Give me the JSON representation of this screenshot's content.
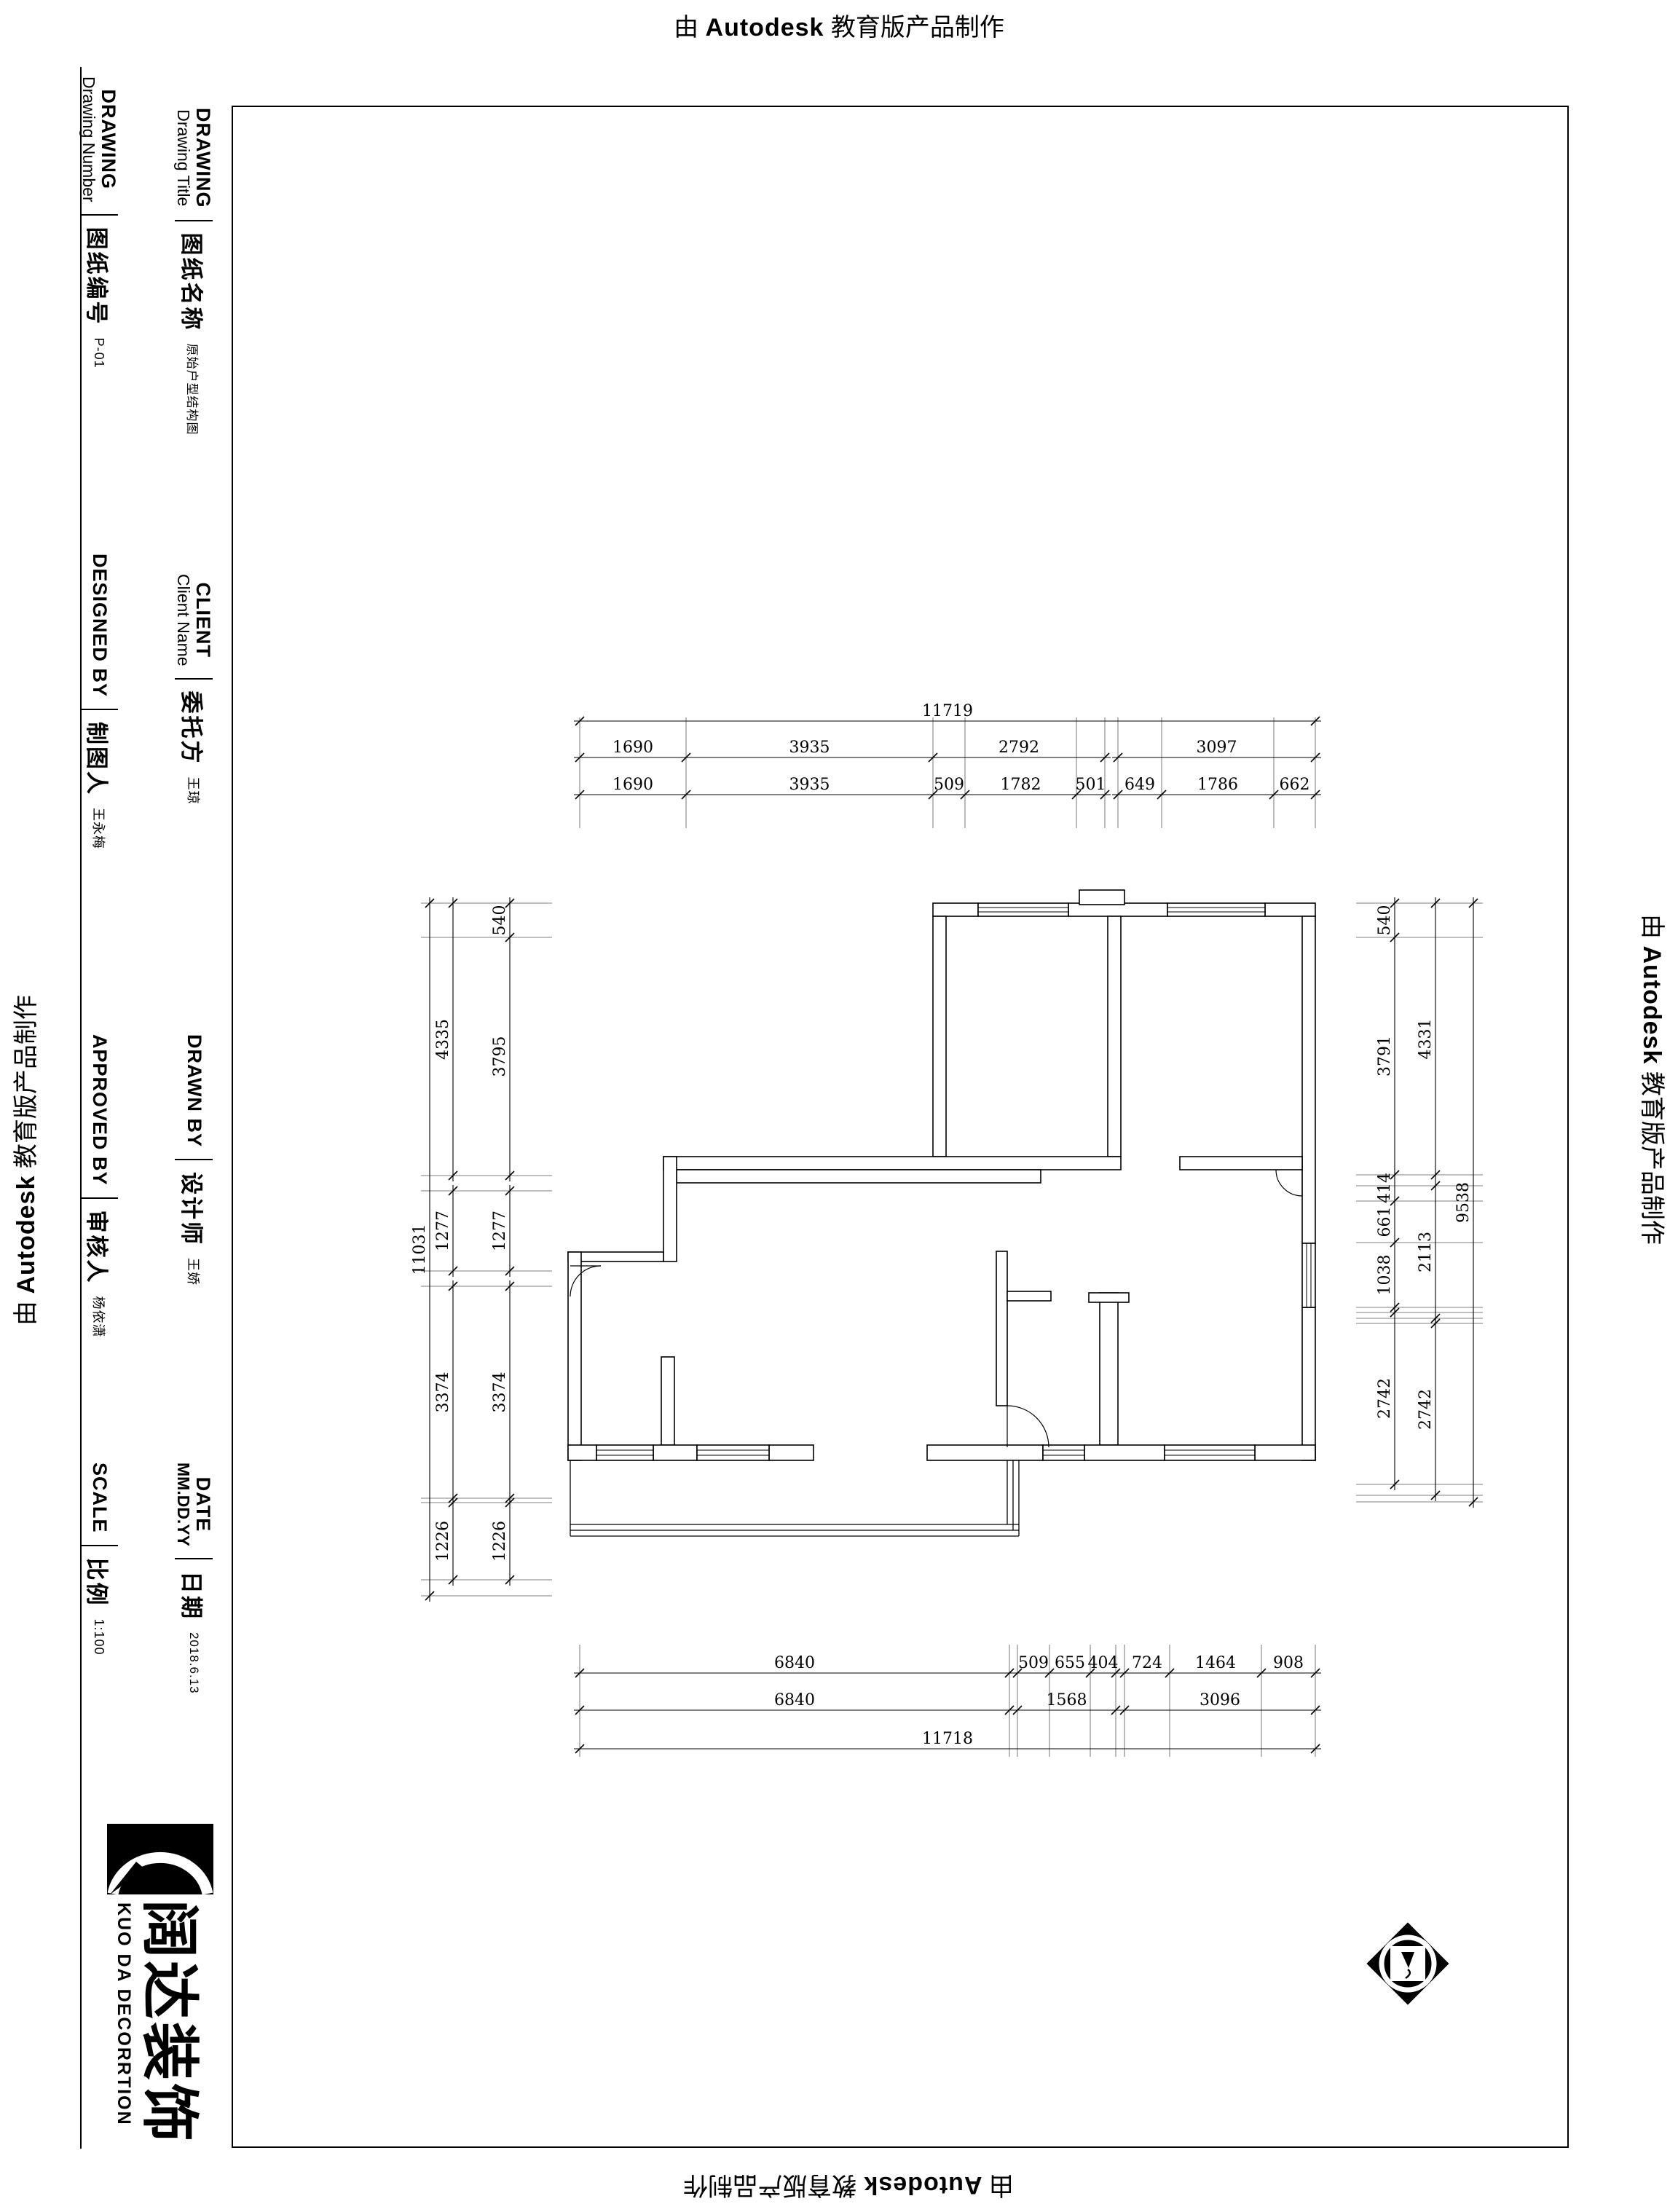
{
  "watermark": {
    "prefix": "由",
    "brand": "Autodesk",
    "suffix": "教育版产品制作"
  },
  "title_block": {
    "fields": [
      {
        "id": "drawing-number",
        "en_bold": "DRAWING",
        "en_sub": "Drawing Number",
        "zh": "图纸编号",
        "value": "P-01"
      },
      {
        "id": "drawing-title",
        "en_bold": "DRAWING",
        "en_sub": "Drawing Title",
        "zh": "图纸名称",
        "value": "原始户型结构图"
      },
      {
        "id": "client",
        "en_bold": "CLIENT",
        "en_sub": "Client Name",
        "zh": "委托方",
        "value": "王琼"
      },
      {
        "id": "designed-by",
        "en_bold": "DESIGNED BY",
        "en_sub": "",
        "zh": "制图人",
        "value": "王永梅"
      },
      {
        "id": "drawn-by",
        "en_bold": "DRAWN BY",
        "en_sub": "",
        "zh": "设计师",
        "value": "王娇"
      },
      {
        "id": "approved-by",
        "en_bold": "APPROVED BY",
        "en_sub": "",
        "zh": "审核人",
        "value": "杨依潇"
      },
      {
        "id": "date",
        "en_bold": "DATE",
        "en_sub": "MM.DD.YY",
        "zh": "日期",
        "value": "2018.6.13"
      },
      {
        "id": "scale",
        "en_bold": "SCALE",
        "en_sub": "",
        "zh": "比例",
        "value": "1:100"
      }
    ]
  },
  "logo": {
    "cn": "阔达装饰",
    "en": "KUO DA DECORRTION"
  },
  "plan": {
    "dims_top": [
      [
        "11719"
      ],
      [
        "1690",
        "3935",
        "2792",
        "3097"
      ],
      [
        "1690",
        "3935",
        "509",
        "1782",
        "501",
        "649",
        "1786",
        "662"
      ]
    ],
    "dims_bottom": [
      [
        "6840",
        "509",
        "655",
        "404",
        "724",
        "1464",
        "908"
      ],
      [
        "6840",
        "1568",
        "3096"
      ],
      [
        "11718"
      ]
    ],
    "dims_left": [
      [
        "540",
        "3795",
        "1277",
        "3374",
        "1226"
      ],
      [
        "4335",
        "1277",
        "3374",
        "1226"
      ],
      [
        "11031"
      ]
    ],
    "dims_right": [
      [
        "540",
        "3791",
        "414",
        "661",
        "1038",
        "2742"
      ],
      [
        "4331",
        "2113",
        "2742"
      ],
      [
        "9538"
      ]
    ]
  }
}
